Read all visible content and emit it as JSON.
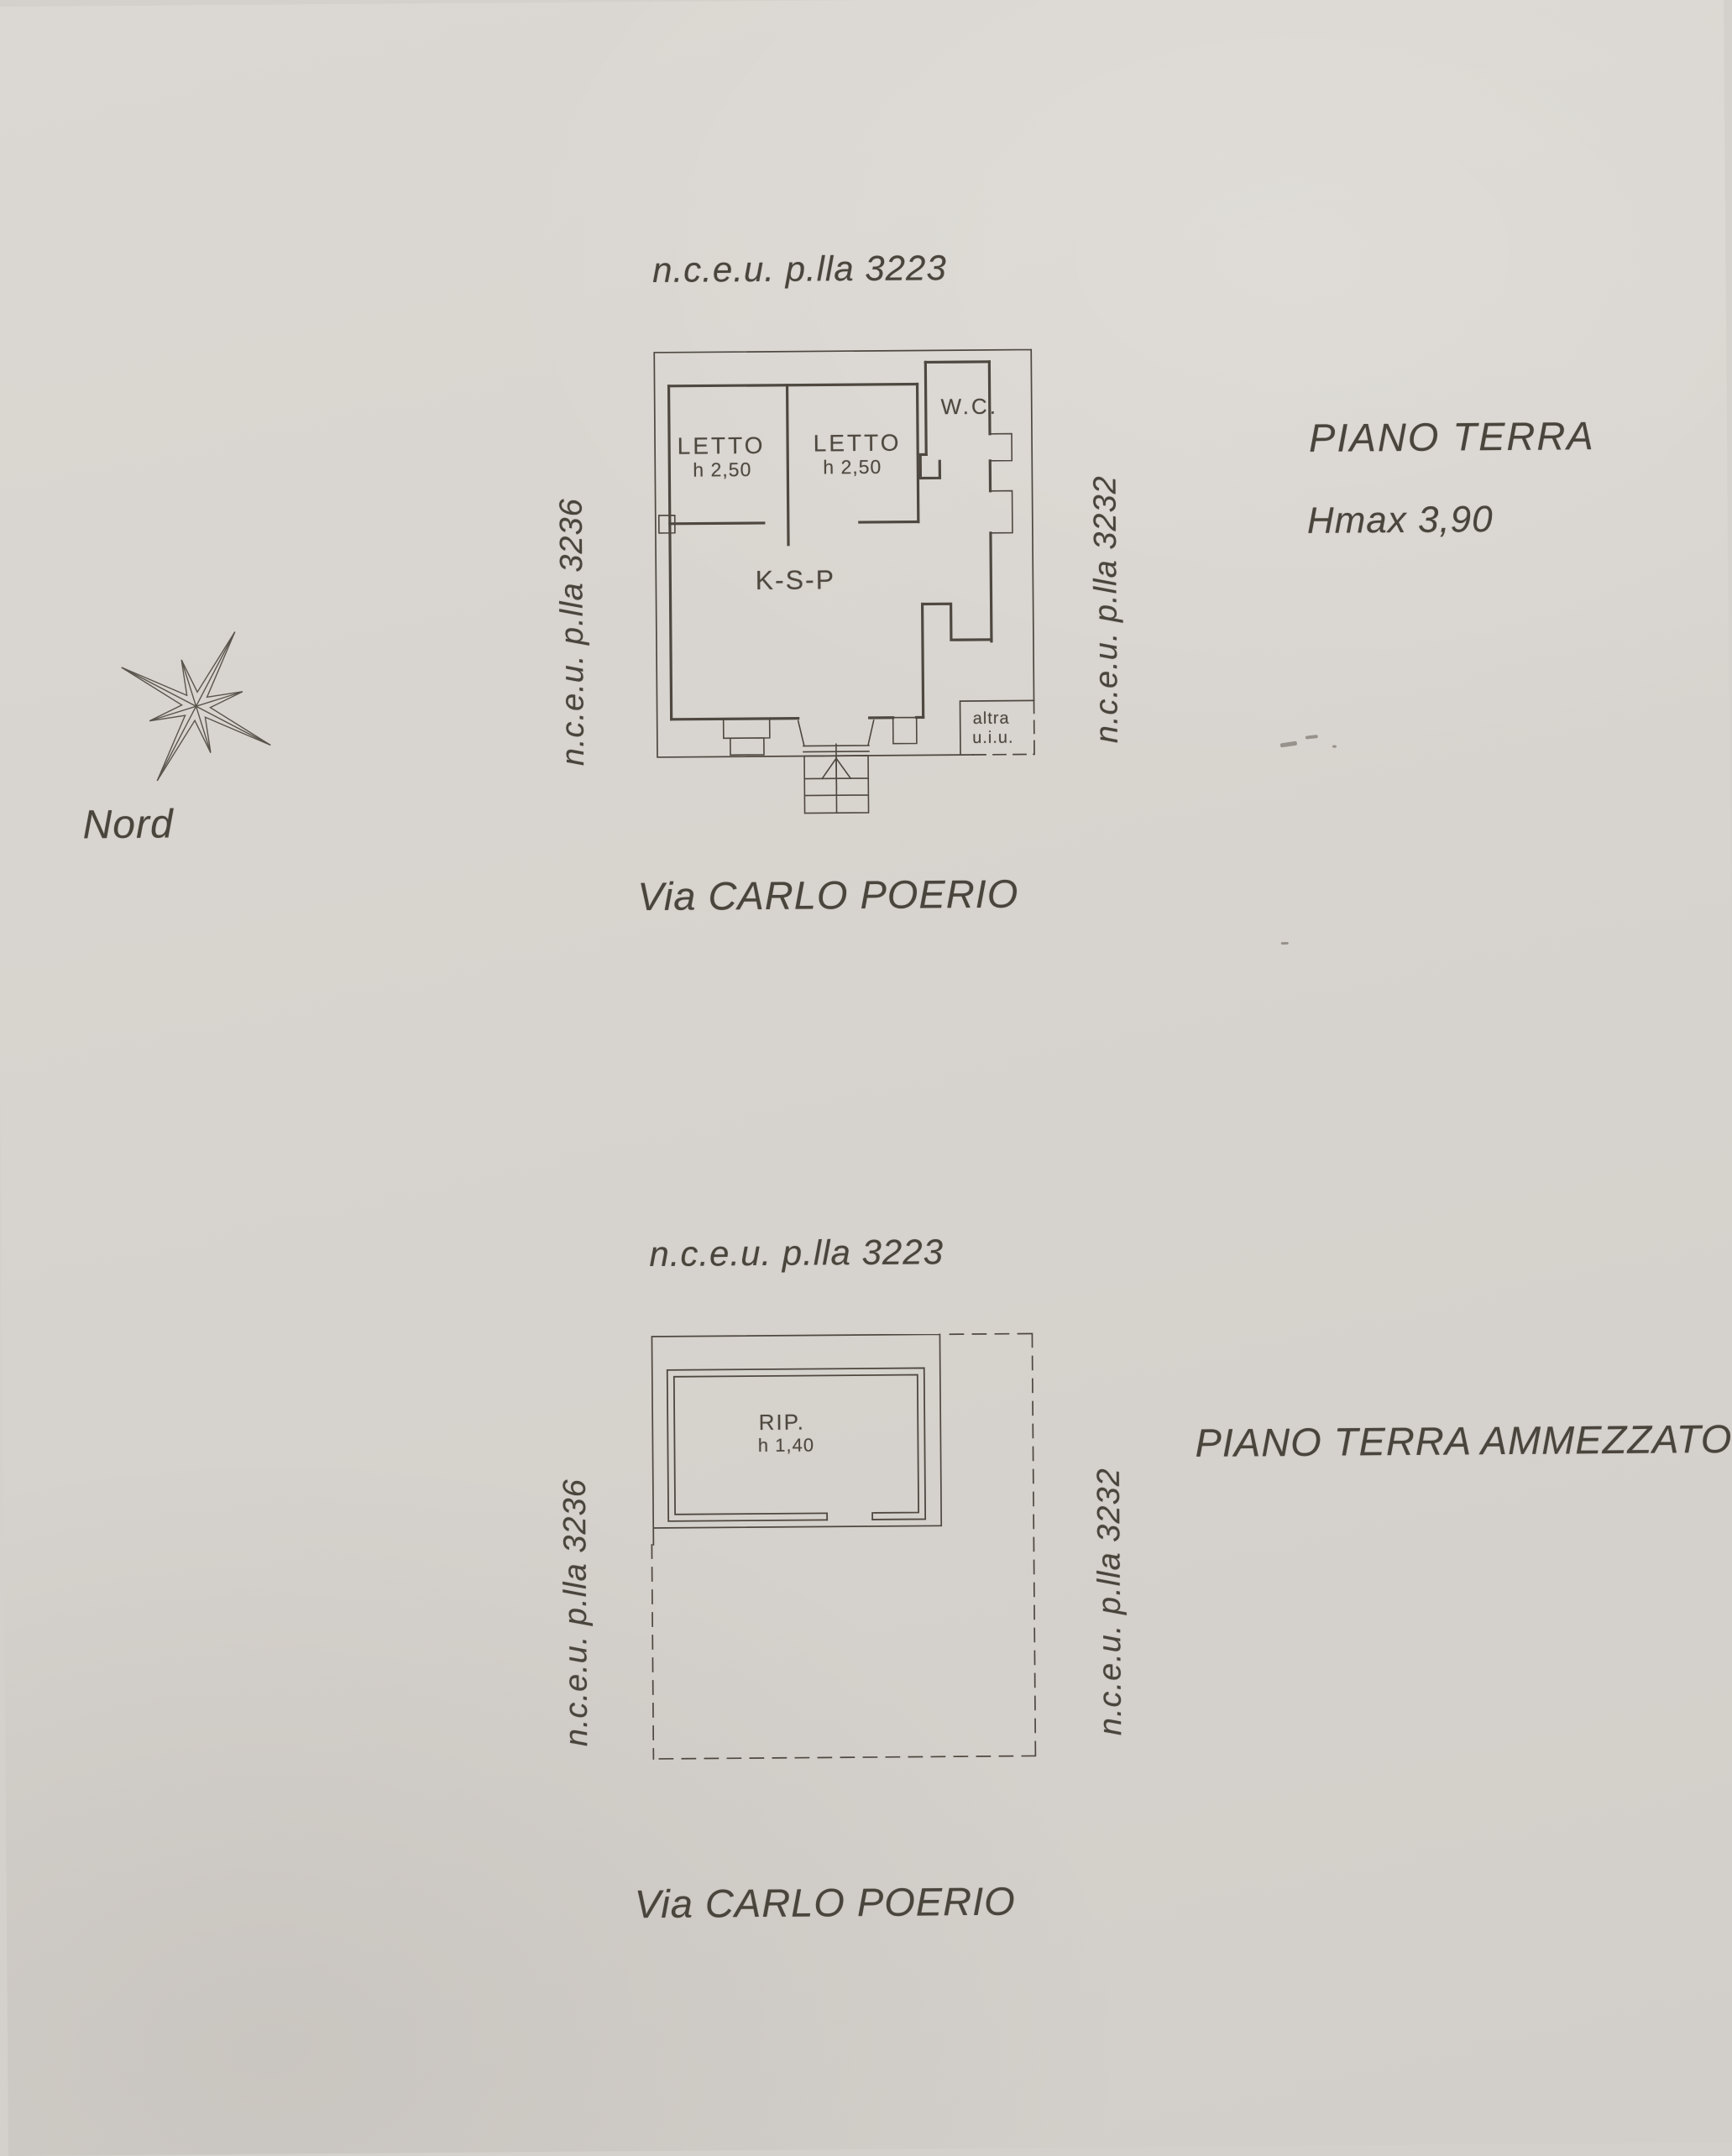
{
  "page": {
    "background_color": "#d7d3ce",
    "line_color": "#4e4840",
    "text_color": "#4a453c"
  },
  "compass": {
    "label": "Nord"
  },
  "floor1": {
    "parcel_top": "n.c.e.u. p.lla 3223",
    "parcel_left": "n.c.e.u. p.lla 3236",
    "parcel_right": "n.c.e.u. p.lla 3232",
    "title": "PIANO TERRA",
    "max_height": "Hmax 3,90",
    "street": "Via CARLO POERIO",
    "rooms": {
      "letto1": {
        "name": "LETTO",
        "height": "h 2,50"
      },
      "letto2": {
        "name": "LETTO",
        "height": "h 2,50"
      },
      "wc": {
        "name": "W.C."
      },
      "ksp": {
        "name": "K-S-P"
      },
      "altra": {
        "line1": "altra",
        "line2": "u.i.u."
      }
    }
  },
  "floor2": {
    "parcel_top": "n.c.e.u. p.lla 3223",
    "parcel_left": "n.c.e.u. p.lla 3236",
    "parcel_right": "n.c.e.u. p.lla 3232",
    "title": "PIANO TERRA AMMEZZATO",
    "street": "Via CARLO POERIO",
    "rooms": {
      "rip": {
        "name": "RIP.",
        "height": "h 1,40"
      }
    }
  }
}
